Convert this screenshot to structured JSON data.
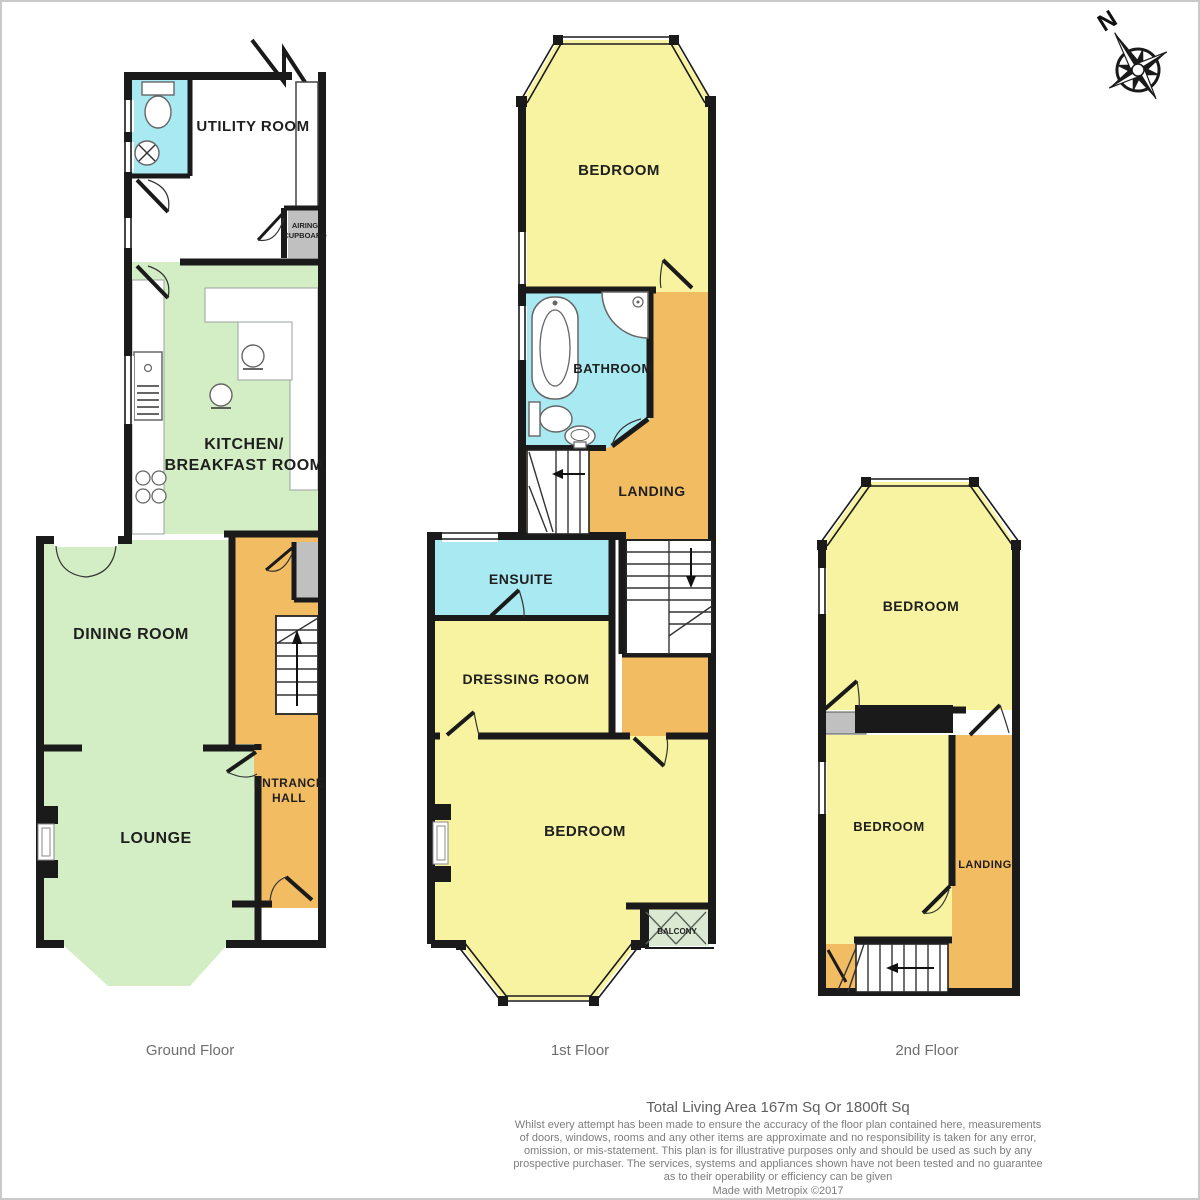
{
  "compass": {
    "north_label": "N"
  },
  "floors": {
    "ground": {
      "label": "Ground Floor",
      "rooms": {
        "utility": "UTILITY ROOM",
        "airing_line1": "AIRING",
        "airing_line2": "CUPBOARD",
        "kitchen_line1": "KITCHEN/",
        "kitchen_line2": "BREAKFAST ROOM",
        "dining": "DINING ROOM",
        "entrance_line1": "ENTRANCE",
        "entrance_line2": "HALL",
        "lounge": "LOUNGE"
      }
    },
    "first": {
      "label": "1st Floor",
      "rooms": {
        "bedroom_front": "BEDROOM",
        "bathroom": "BATHROOM",
        "landing": "LANDING",
        "ensuite": "ENSUITE",
        "dressing": "DRESSING ROOM",
        "bedroom_rear": "BEDROOM",
        "balcony": "BALCONY"
      }
    },
    "second": {
      "label": "2nd Floor",
      "rooms": {
        "bedroom_front": "BEDROOM",
        "bedroom_rear": "BEDROOM",
        "landing": "LANDING"
      }
    }
  },
  "footer": {
    "total_area": "Total Living Area 167m Sq Or 1800ft Sq",
    "disclaimer_lines": [
      "Whilst every attempt has been made to ensure the accuracy of the floor plan contained here, measurements",
      "of doors, windows, rooms and any other items are approximate and no responsibility is taken for any error,",
      "omission, or mis-statement. This plan is for illustrative purposes only and should be used as such by any",
      "prospective purchaser. The services, systems and appliances shown have not been tested and no guarantee",
      "as to their operability or efficiency can be given"
    ],
    "credit": "Made with Metropix ©2017"
  },
  "colors": {
    "wall": "#1a1a1a",
    "room_yellow": "#F7F3A1",
    "room_green": "#D3EEC4",
    "room_cyan": "#A9E9F2",
    "room_orange": "#F2BC63",
    "cupboard_gray": "#C0C0C0",
    "balcony_green": "#DCE9D2"
  }
}
